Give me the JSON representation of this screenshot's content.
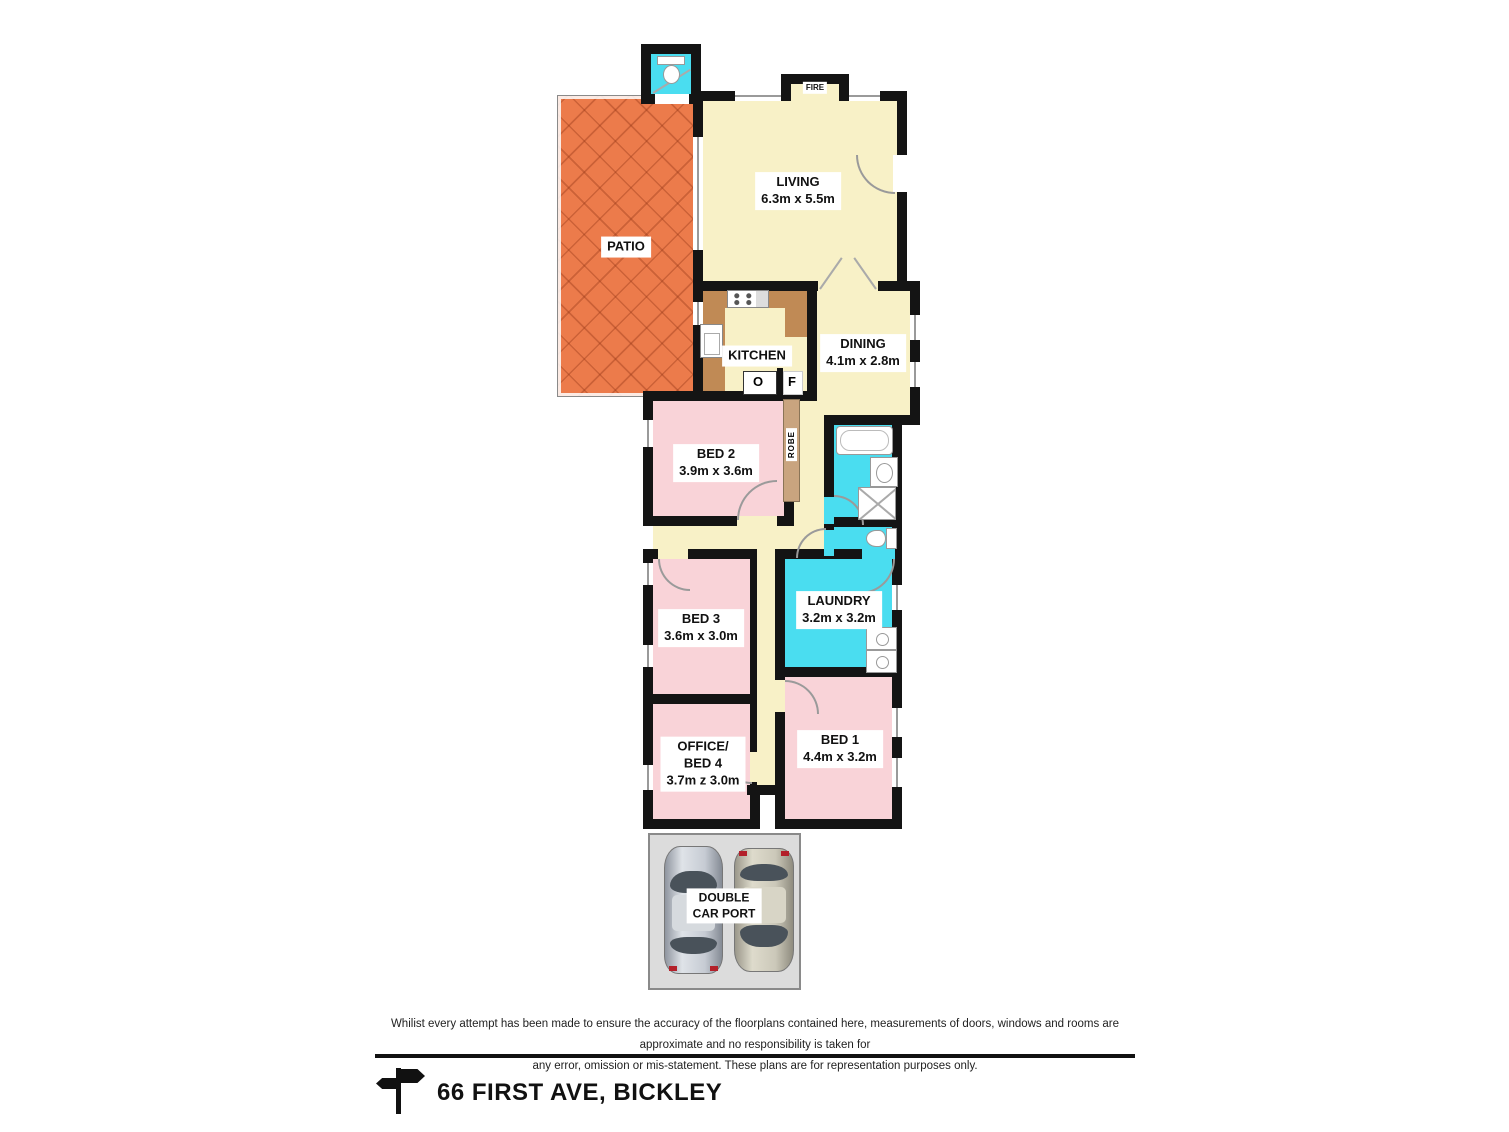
{
  "plan": {
    "rooms": {
      "patio": {
        "name": "PATIO"
      },
      "living": {
        "name": "LIVING",
        "dims": "6.3m x 5.5m"
      },
      "fire": {
        "name": "FIRE"
      },
      "kitchen": {
        "name": "KITCHEN",
        "oven": "O",
        "fridge": "F"
      },
      "dining": {
        "name": "DINING",
        "dims": "4.1m x 2.8m"
      },
      "bed2": {
        "name": "BED 2",
        "dims": "3.9m x 3.6m"
      },
      "robe": {
        "name": "ROBE"
      },
      "laundry": {
        "name": "LAUNDRY",
        "dims": "3.2m x 3.2m"
      },
      "bed3": {
        "name": "BED 3",
        "dims": "3.6m x 3.0m"
      },
      "office": {
        "line1": "OFFICE/",
        "line2": "BED 4",
        "dims": "3.7m z 3.0m"
      },
      "bed1": {
        "name": "BED 1",
        "dims": "4.4m x 3.2m"
      },
      "carport": {
        "line1": "DOUBLE",
        "line2": "CAR PORT"
      }
    },
    "colors": {
      "wall": "#141414",
      "living_floor": "#F8F1C7",
      "bedroom_floor": "#F9D3D8",
      "wet_area_floor": "#4ADDF0",
      "kitchen_bench": "#C08A55",
      "patio": "#EC7B4B",
      "robe": "#C9A47F",
      "carport": "#DCDCDC"
    }
  },
  "footer": {
    "disclaimer_line1": "Whilist every attempt has been made to ensure the accuracy of the floorplans contained here, measurements of doors, windows and rooms are approximate and no responsibility is taken for",
    "disclaimer_line2": "any error, omission or mis-statement. These plans are for representation purposes only.",
    "address": "66 FIRST AVE, BICKLEY"
  }
}
